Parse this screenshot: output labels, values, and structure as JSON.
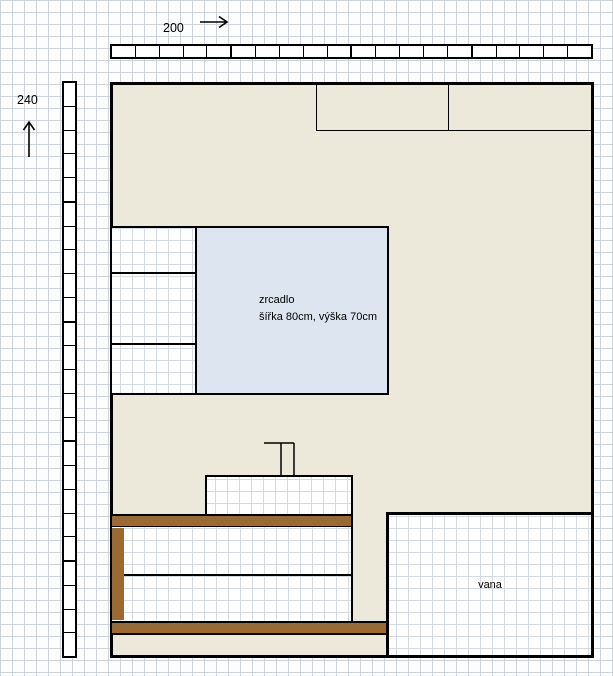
{
  "diagram": {
    "title": "bathroom wall elevation sketch",
    "width_label": "200",
    "height_label": "240",
    "mirror": {
      "line1": "zrcadlo",
      "line2": "šířka 80cm, výška 70cm"
    },
    "bathtub": {
      "label": "vana"
    },
    "rulers": {
      "top_cells": 20,
      "left_cells": 24
    },
    "icons": {
      "width_arrow": "arrow-right",
      "height_arrow": "arrow-up"
    },
    "colors": {
      "wall_fill": "#ECE9DB",
      "mirror_fill": "#DCE5F0",
      "wood_fill": "#9A6A32",
      "outline": "#000000",
      "grid_line": "#CCD3DB",
      "background": "#FDFDFD"
    }
  }
}
